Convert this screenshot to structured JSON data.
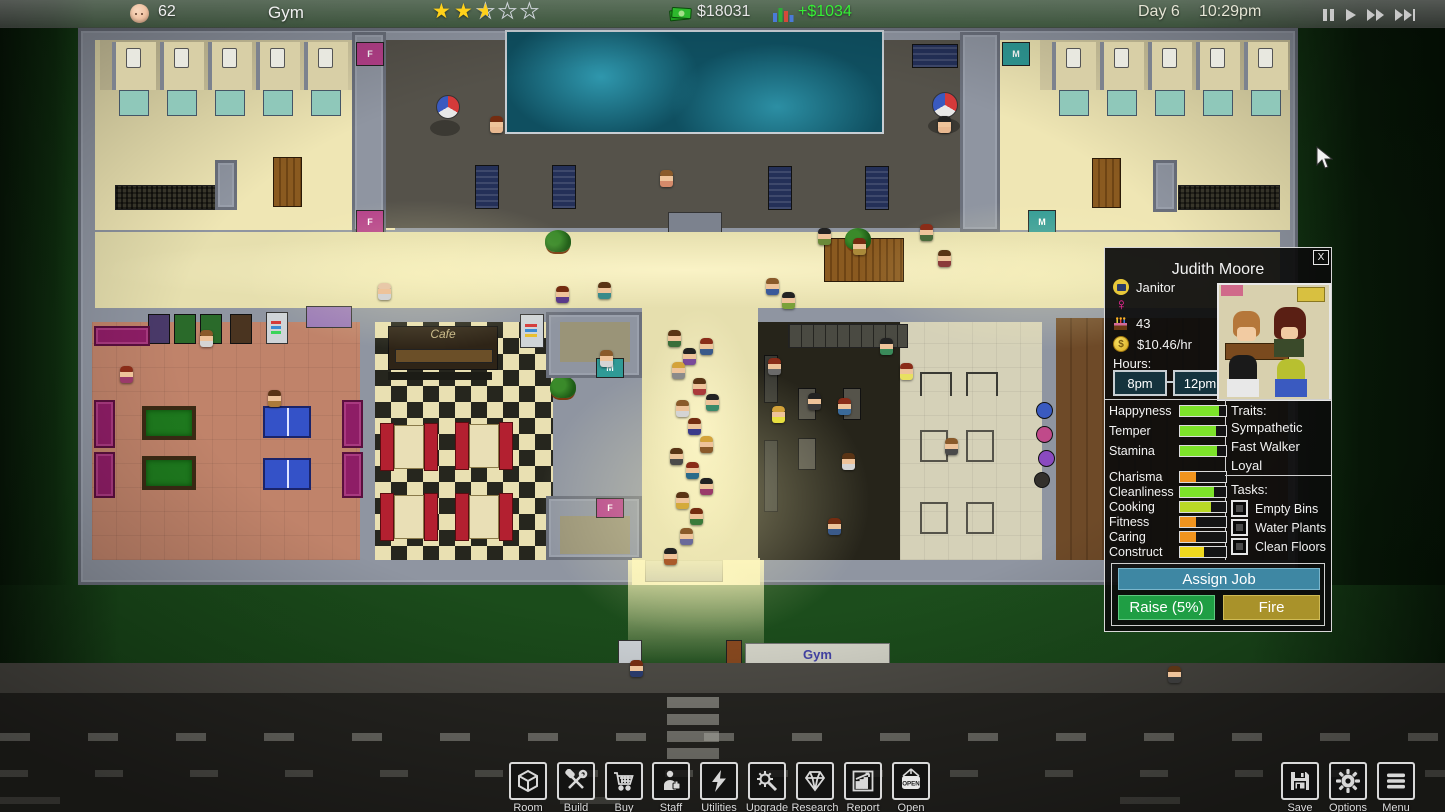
{
  "top_bar": {
    "population": "62",
    "title": "Gym",
    "rating": {
      "full": 2,
      "half": 1,
      "empty": 2
    },
    "money": "$18031",
    "income": "+$1034",
    "day": "Day 6",
    "time": "10:29pm",
    "controls": [
      {
        "label": "pause",
        "icon": "pause-icon"
      },
      {
        "label": "play",
        "icon": "play-icon"
      },
      {
        "label": "fast-forward",
        "icon": "fast-forward-icon"
      },
      {
        "label": "skip",
        "icon": "skip-icon"
      }
    ]
  },
  "world": {
    "gym_sign": "Gym",
    "cafe_sign": "Cafe",
    "door_f": "F",
    "door_m": "M"
  },
  "staff_panel": {
    "close": "X",
    "name": "Judith Moore",
    "role": "Janitor",
    "gender": "female",
    "age": "43",
    "wage": "$10.46/hr",
    "hours_label": "Hours:",
    "hours_start": "8pm",
    "hours_end": "12pm",
    "stats": [
      {
        "label": "Happyness",
        "value": 85,
        "color": "#7de32a",
        "group": 1
      },
      {
        "label": "Temper",
        "value": 78,
        "color": "#7de32a",
        "group": 1
      },
      {
        "label": "Stamina",
        "value": 80,
        "color": "#7de32a",
        "group": 1
      },
      {
        "label": "Charisma",
        "value": 35,
        "color": "#f0941e",
        "group": 2
      },
      {
        "label": "Cleanliness",
        "value": 73,
        "color": "#7de32a",
        "group": 2
      },
      {
        "label": "Cooking",
        "value": 68,
        "color": "#b9d926",
        "group": 2
      },
      {
        "label": "Fitness",
        "value": 35,
        "color": "#f0941e",
        "group": 2
      },
      {
        "label": "Caring",
        "value": 35,
        "color": "#f0941e",
        "group": 2
      },
      {
        "label": "Construct",
        "value": 52,
        "color": "#f0d91e",
        "group": 2
      }
    ],
    "traits_label": "Traits:",
    "traits": [
      "Sympathetic",
      "Fast Walker",
      "Loyal"
    ],
    "tasks_label": "Tasks:",
    "tasks": [
      {
        "label": "Empty Bins",
        "checked": false
      },
      {
        "label": "Water Plants",
        "checked": false
      },
      {
        "label": "Clean Floors",
        "checked": false
      }
    ],
    "assign_button": "Assign Job",
    "raise_button": "Raise (5%)",
    "fire_button": "Fire",
    "button_colors": {
      "assign": "#3e87a3",
      "raise": "#1f9e44",
      "fire": "#a9922a"
    }
  },
  "toolbar": {
    "items": [
      {
        "label": "Room",
        "icon": "room-icon"
      },
      {
        "label": "Build",
        "icon": "build-icon"
      },
      {
        "label": "Buy",
        "icon": "buy-icon"
      },
      {
        "label": "Staff",
        "icon": "staff-icon"
      },
      {
        "label": "Utilities",
        "icon": "utilities-icon"
      },
      {
        "label": "Upgrade",
        "icon": "upgrade-icon"
      },
      {
        "label": "Research",
        "icon": "research-icon"
      },
      {
        "label": "Report",
        "icon": "report-icon"
      },
      {
        "label": "Open",
        "icon": "open-icon"
      }
    ],
    "system": [
      {
        "label": "Save",
        "icon": "save-icon"
      },
      {
        "label": "Options",
        "icon": "options-icon"
      },
      {
        "label": "Menu",
        "icon": "menu-icon"
      }
    ]
  },
  "colors": {
    "income_green": "#35f035",
    "star_gold": "#ffd11a"
  }
}
